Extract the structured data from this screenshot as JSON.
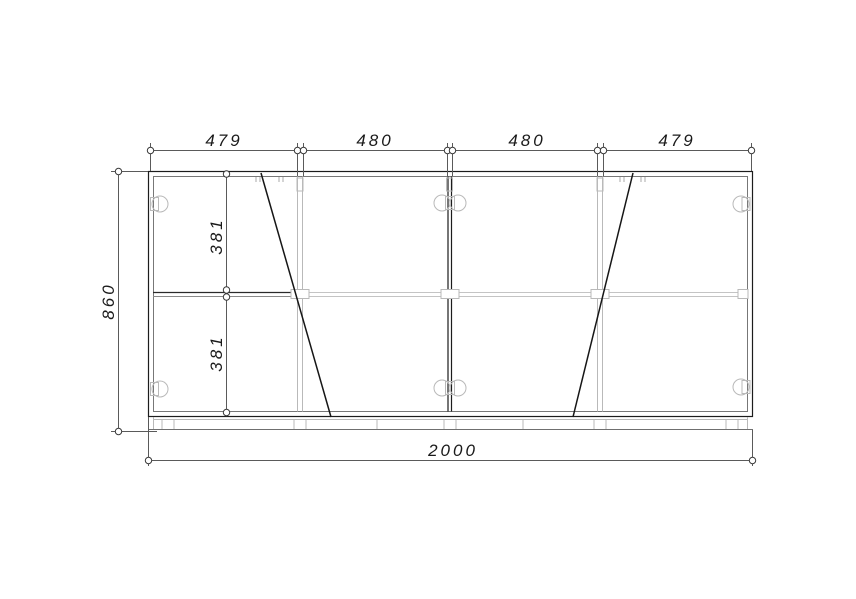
{
  "drawing": {
    "type": "furniture-front-elevation",
    "dimensions": {
      "top_sections": [
        {
          "label": "479"
        },
        {
          "label": "480"
        },
        {
          "label": "480"
        },
        {
          "label": "479"
        }
      ],
      "height_overall": {
        "label": "860"
      },
      "inner_heights": [
        {
          "label": "381"
        },
        {
          "label": "381"
        }
      ],
      "width_overall": {
        "label": "2000"
      }
    },
    "colors": {
      "background": "#ffffff",
      "outline": "#1c1c1c",
      "secondary_line": "#777777",
      "hardware": "#b9b9b9",
      "dimension_line": "#5a5a5a",
      "text": "#1a1a1a"
    }
  }
}
